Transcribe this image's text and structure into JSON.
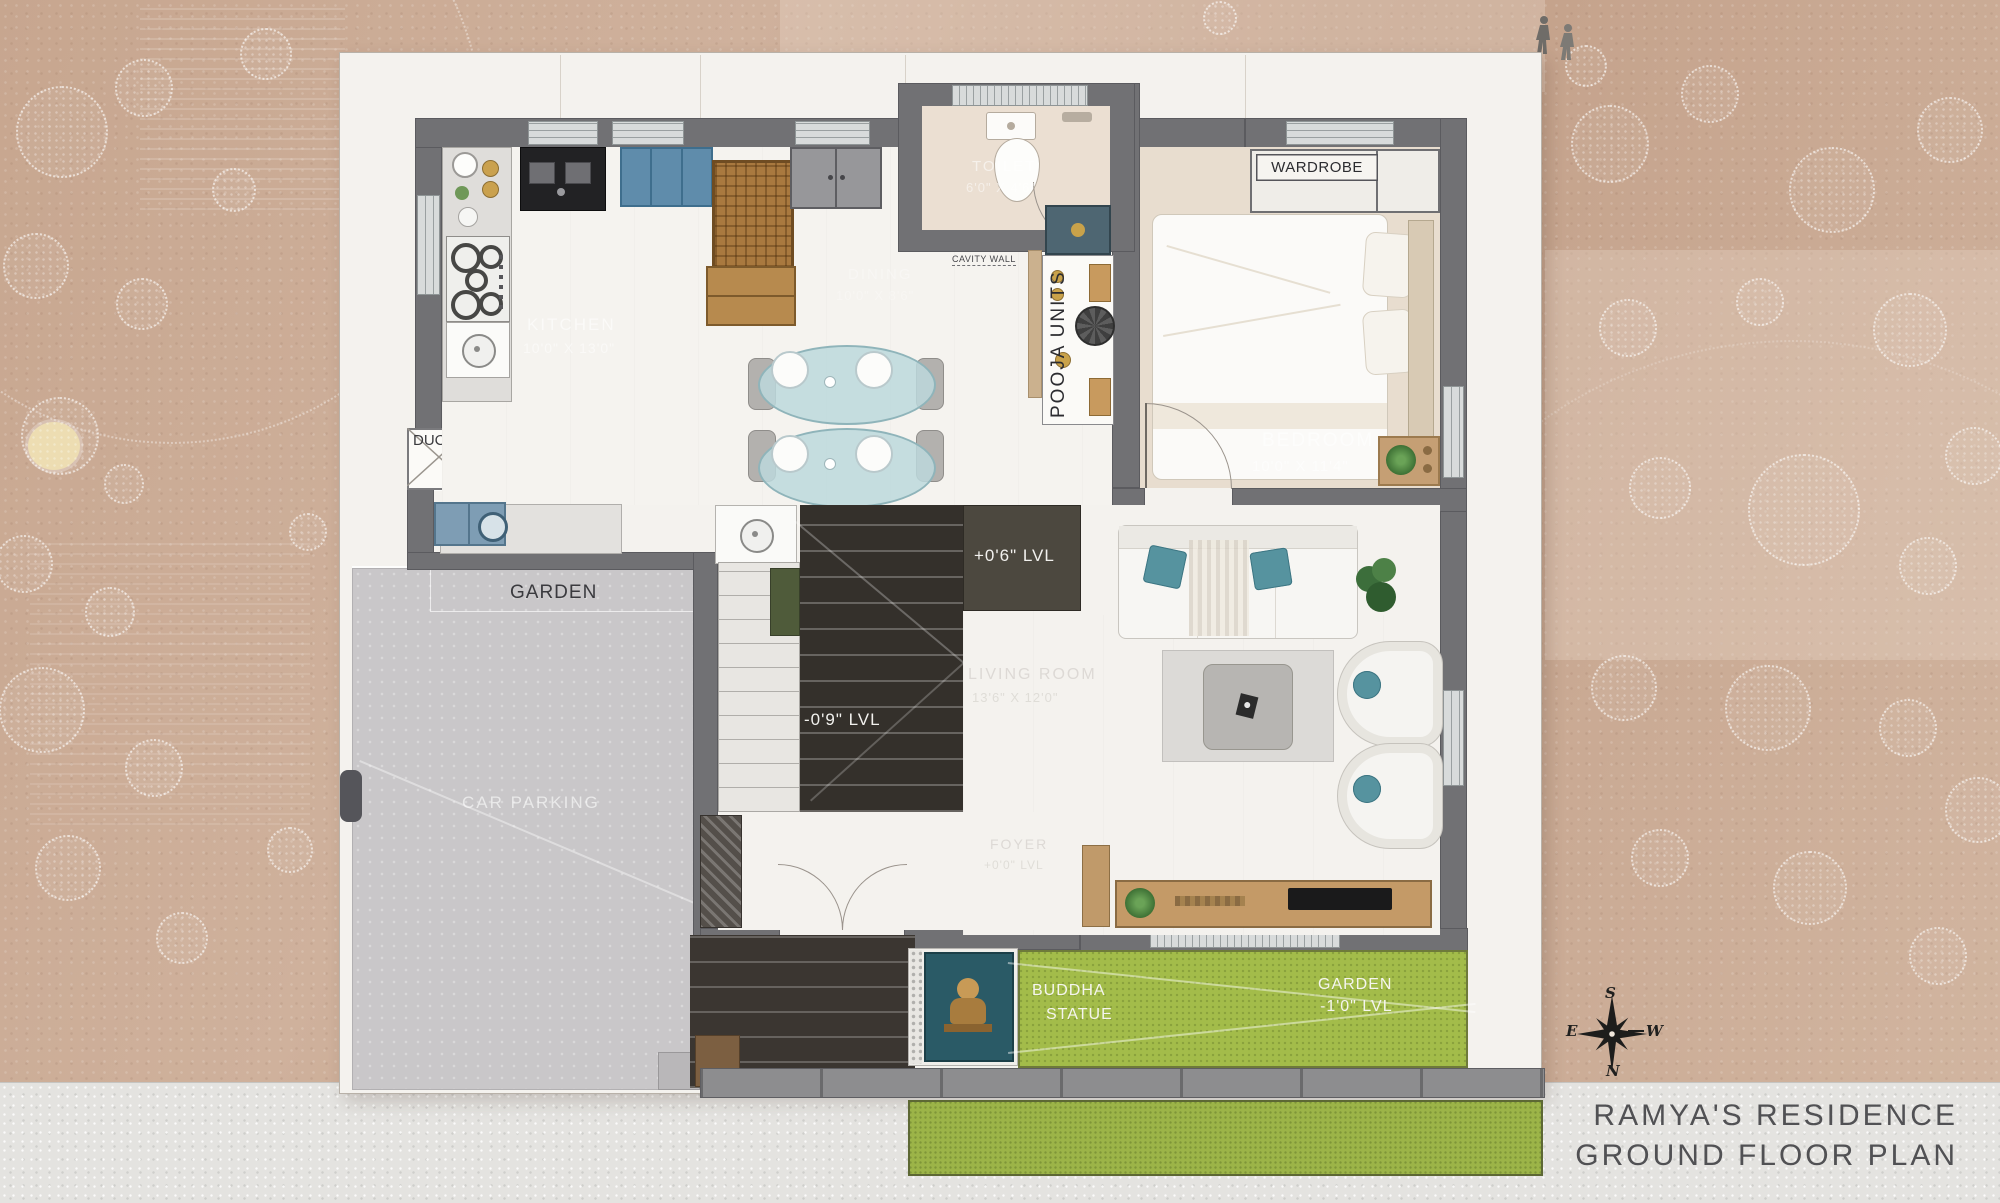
{
  "plan": {
    "rooms": {
      "kitchen": {
        "name": "KITCHEN",
        "dim": "10'0\" X 13'0\""
      },
      "toilet": {
        "name": "TOILET",
        "dim": "6'0\" X 4'6\""
      },
      "bedroom": {
        "name": "BEDROOM",
        "dim": "10'0\" X 11'4\""
      },
      "dining": {
        "name": "DINING",
        "dim": "10'0\" X 8'6\""
      },
      "living": {
        "name": "LIVING ROOM",
        "dim": "13'6\" X 12'0\""
      },
      "foyer": {
        "name": "FOYER",
        "dim": "+0'0\" LVL"
      }
    },
    "labels": {
      "wardrobe": "WARDROBE",
      "duct": "DUCT",
      "pooja_units": "POOJA UNITS",
      "cavity_wall": "CAVITY WALL",
      "garden_left": "GARDEN",
      "car_parking": "CAR PARKING",
      "buddha_statue_line1": "BUDDHA",
      "buddha_statue_line2": "STATUE",
      "garden_right_line1": "GARDEN",
      "garden_right_line2": "-1'0\" LVL",
      "landing_level": "+0'6\" LVL",
      "stair_level": "-0'9\" LVL"
    }
  },
  "compass": {
    "top": "S",
    "bottom": "N",
    "left": "E",
    "right": "W"
  },
  "title_block": {
    "line1": "RAMYA'S RESIDENCE",
    "line2": "GROUND FLOOR PLAN"
  },
  "colors": {
    "wall": "#717174",
    "floor": "#f3f1ec",
    "floor_warm": "#e8ddcf",
    "garden_green": "#a3bc4a",
    "accent_teal": "#56939f",
    "stair_dark": "#34302b",
    "site_tan": "#c9ab97"
  }
}
